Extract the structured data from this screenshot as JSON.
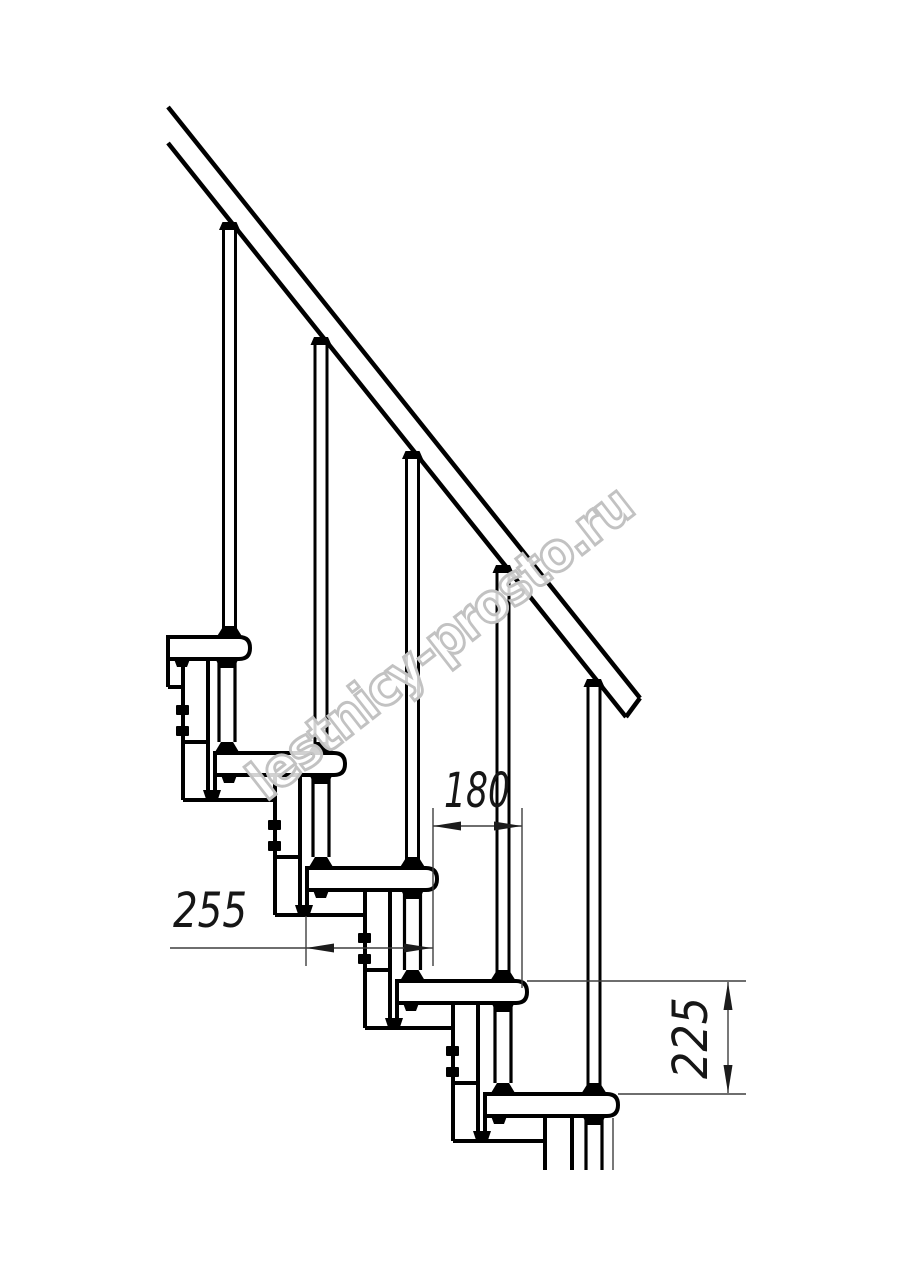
{
  "document": {
    "type": "technical-drawing",
    "subject": "Modular staircase side elevation with handrail and balusters"
  },
  "watermark": {
    "text": "lestnicy-prosto.ru",
    "outline_color": "#c2c2c2"
  },
  "dims": {
    "pitch_upper": "180",
    "pitch_lower": "255",
    "rise": "225"
  },
  "colors": {
    "line": "#000000",
    "dim_line": "#3f3f3f",
    "text": "#161616",
    "background": "#ffffff"
  },
  "figure": {
    "visible_treads": 5,
    "visible_balusters": 5,
    "handrail_count": 1
  }
}
